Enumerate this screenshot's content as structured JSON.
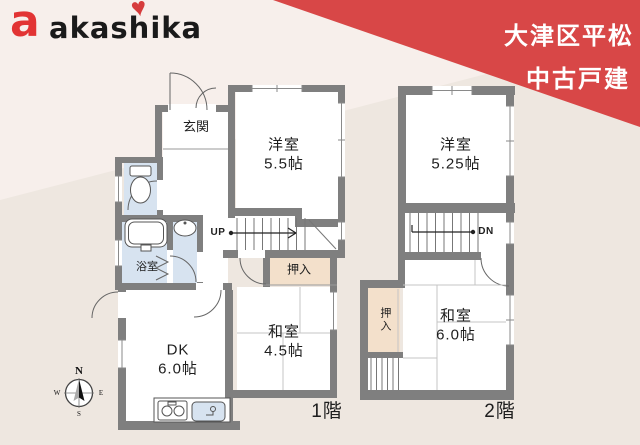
{
  "logo": {
    "mark": "a",
    "name": "akashika"
  },
  "header": {
    "line1": "大津区平松",
    "line2": "中古戸建"
  },
  "floor1": {
    "label": "1階",
    "stairs_up": "UP",
    "rooms": {
      "genkan": "玄関",
      "yoshitsu": {
        "name": "洋室",
        "size": "5.5帖"
      },
      "washitsu": {
        "name": "和室",
        "size": "4.5帖"
      },
      "dk": {
        "name": "DK",
        "size": "6.0帖"
      },
      "oshiire": "押入",
      "yokushitsu": "浴室"
    }
  },
  "floor2": {
    "label": "2階",
    "stairs_down": "DN",
    "rooms": {
      "yoshitsu": {
        "name": "洋室",
        "size": "5.25帖"
      },
      "washitsu": {
        "name": "和室",
        "size": "6.0帖"
      },
      "oshiire": "押入"
    }
  },
  "compass": {
    "n": "N",
    "e": "E",
    "w": "W",
    "s": "S"
  },
  "colors": {
    "accent_red": "#d84747",
    "logo_red": "#e23434",
    "wall_gray": "#7f7f7f",
    "wet_area_blue": "#d7e3f0",
    "closet_beige": "#f3e0cb",
    "background": "#eee7e0",
    "background_light": "#f7efeb"
  }
}
